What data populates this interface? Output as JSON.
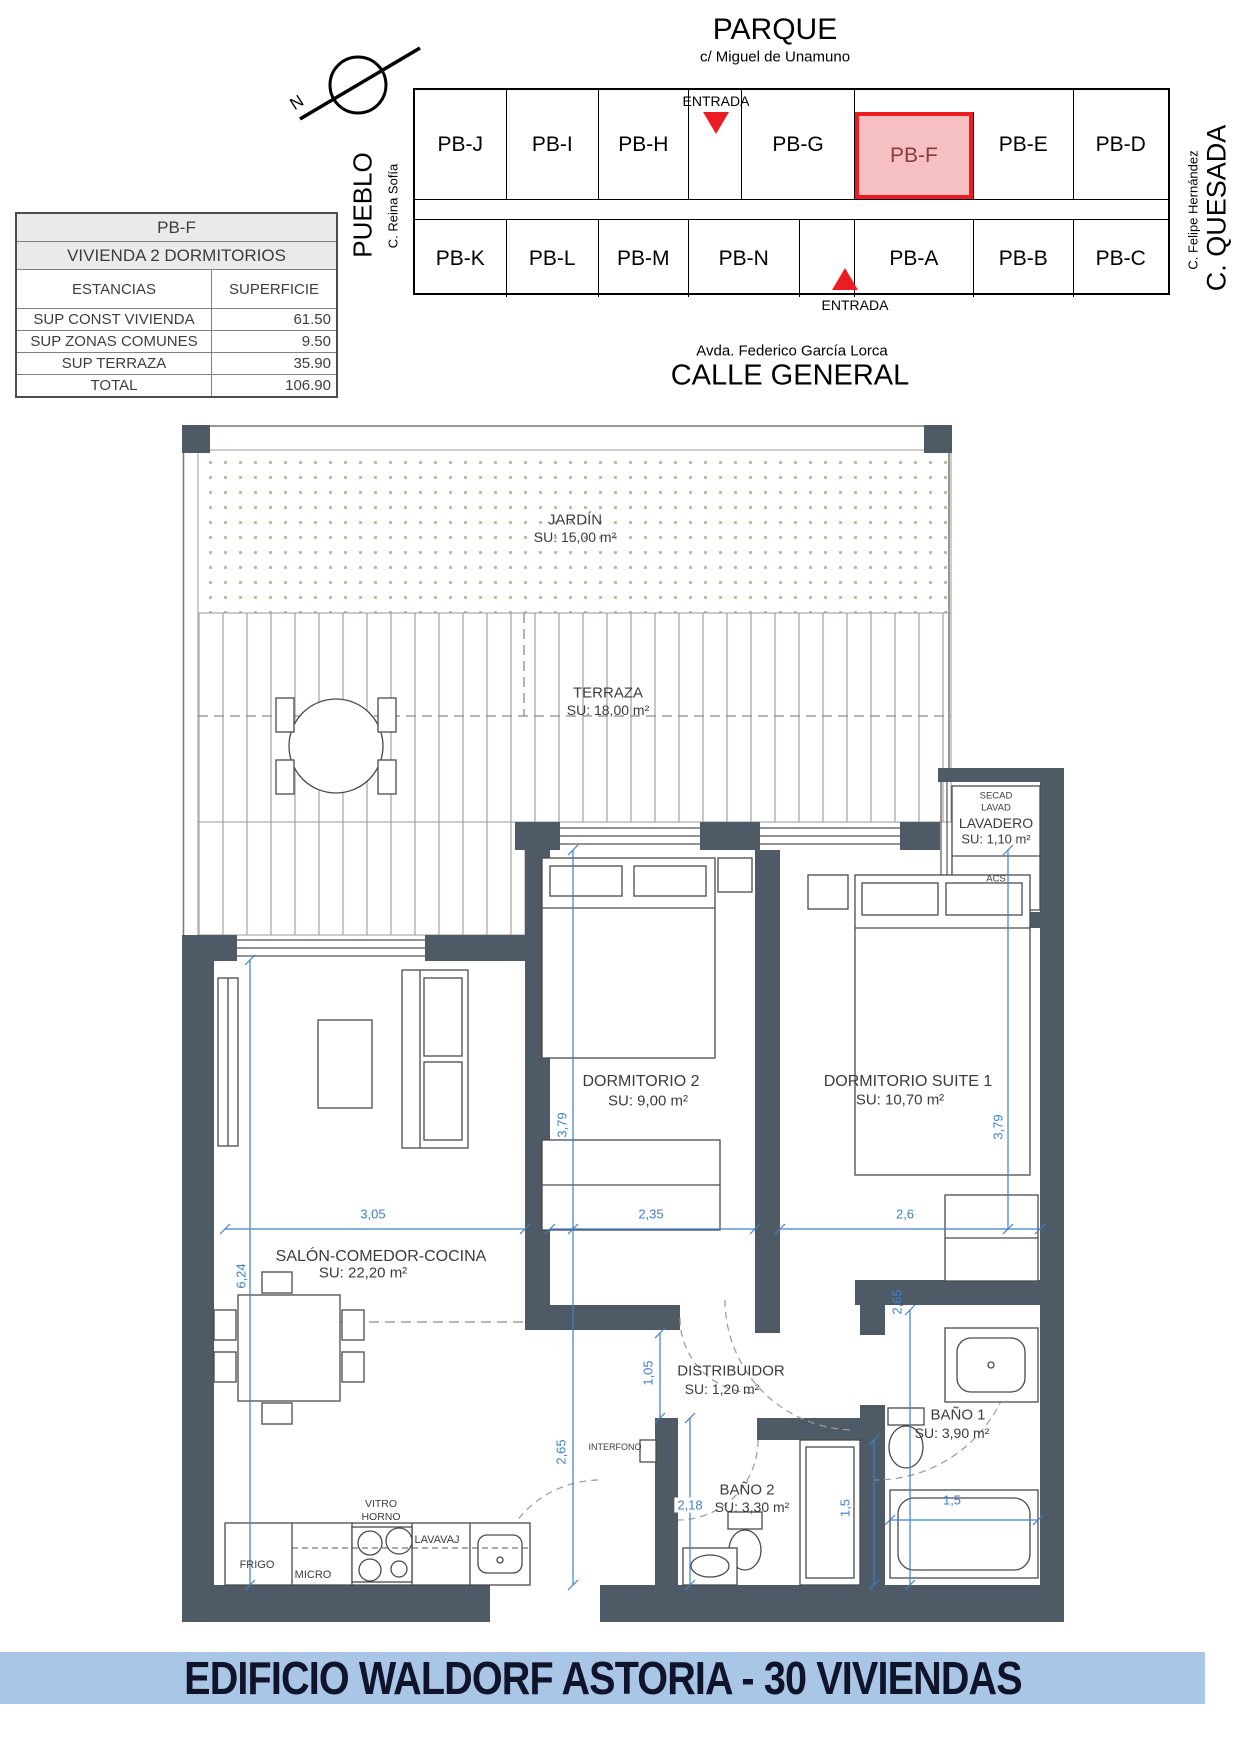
{
  "site_plan": {
    "parque": "PARQUE",
    "street_top": "c/ Miguel de Unamuno",
    "entrada_top": "ENTRADA",
    "entrada_bottom": "ENTRADA",
    "street_bottom": "Avda. Federico García Lorca",
    "calle_general": "CALLE GENERAL",
    "pueblo": "PUEBLO",
    "reina_sofia": "C. Reina Sofía",
    "felipe_hernandez": "C. Felipe Hernández",
    "quesada": "C. QUESADA",
    "north_label": "N",
    "highlight_color": "#ec1c24",
    "top_row": [
      {
        "label": "PB-J"
      },
      {
        "label": "PB-I"
      },
      {
        "label": "PB-H"
      },
      {
        "label": "PB-G"
      },
      {
        "label": "PB-F",
        "highlighted": true
      },
      {
        "label": "PB-E"
      },
      {
        "label": "PB-D"
      }
    ],
    "bottom_row": [
      {
        "label": "PB-K"
      },
      {
        "label": "PB-L"
      },
      {
        "label": "PB-M"
      },
      {
        "label": "PB-N"
      },
      {
        "label": "PB-A"
      },
      {
        "label": "PB-B"
      },
      {
        "label": "PB-C"
      }
    ]
  },
  "summary_table": {
    "unit": "PB-F",
    "type": "VIVIENDA 2 DORMITORIOS",
    "col_estancias": "ESTANCIAS",
    "col_superficie": "SUPERFICIE",
    "rows": [
      {
        "label": "SUP CONST VIVIENDA",
        "value": "61.50"
      },
      {
        "label": "SUP ZONAS COMUNES",
        "value": "9.50"
      },
      {
        "label": "SUP TERRAZA",
        "value": "35.90"
      },
      {
        "label": "TOTAL",
        "value": "106.90"
      }
    ]
  },
  "floor_plan": {
    "dim_color": "#4080c8",
    "wall_color": "#4e5a66",
    "rooms": {
      "jardin": {
        "name": "JARDÍN",
        "area": "SU: 15,00 m²"
      },
      "terraza": {
        "name": "TERRAZA",
        "area": "SU: 18,00 m²"
      },
      "lavadero": {
        "name": "LAVADERO",
        "area": "SU: 1,10 m²",
        "secad": "SECAD",
        "lavad": "LAVAD",
        "acs": "ACS"
      },
      "dormitorio2": {
        "name": "DORMITORIO 2",
        "area": "SU: 9,00 m²"
      },
      "suite": {
        "name": "DORMITORIO SUITE 1",
        "area": "SU: 10,70 m²"
      },
      "salon": {
        "name": "SALÓN-COMEDOR-COCINA",
        "area": "SU: 22,20 m²"
      },
      "distribuidor": {
        "name": "DISTRIBUIDOR",
        "area": "SU: 1,20 m²"
      },
      "bano1": {
        "name": "BAÑO 1",
        "area": "SU: 3,90 m²"
      },
      "bano2": {
        "name": "BAÑO 2",
        "area": "SU: 3,30 m²"
      }
    },
    "appliances": {
      "vitro": "VITRO",
      "horno": "HORNO",
      "frigo": "FRIGO",
      "micro": "MICRO",
      "lavavaj": "LAVAVAJ",
      "interfono": "INTERFONO"
    },
    "dimensions": {
      "salon_width": "3,05",
      "dorm2_width": "2,35",
      "suite_width": "2,6",
      "dorm2_depth": "3,79",
      "suite_depth": "3,79",
      "salon_depth": "6,24",
      "distribuidor_depth": "1,05",
      "salon_lower_depth": "2,65",
      "bano2_depth": "2,18",
      "bano2_width": "1,5",
      "bano1_width": "1,5",
      "bano1_depth": "2,65"
    }
  },
  "footer": {
    "title": "EDIFICIO WALDORF ASTORIA - 30 VIVIENDAS"
  }
}
